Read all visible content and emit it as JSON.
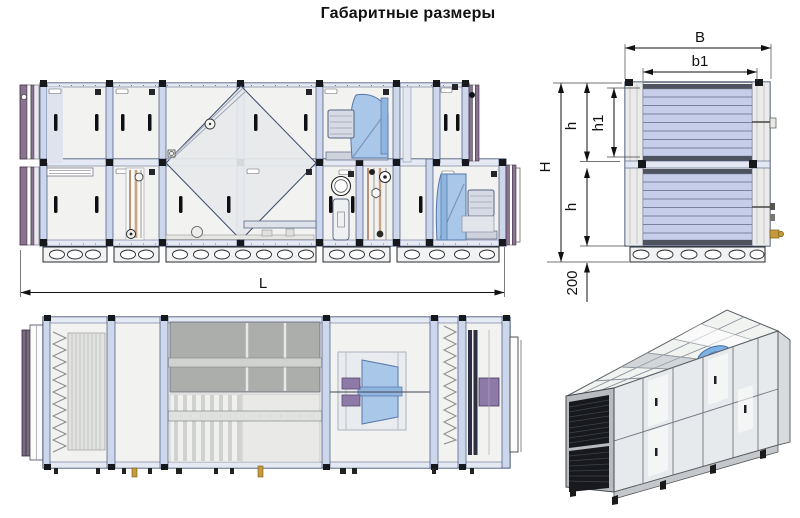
{
  "title": "Габаритные размеры",
  "dimensions": {
    "length": "L",
    "width": "B",
    "inner_width": "b1",
    "height": "H",
    "section_height": "h",
    "inner_height": "h1",
    "base_height": "200"
  },
  "colors": {
    "outline": "#2e3d5c",
    "frame_fill": "#cdd7eb",
    "panel_fill": "#f2f2f0",
    "fan_blue": "#a9c7e8",
    "louver_blue": "#c6cee9",
    "louver_strip": "#4e545f",
    "flange_purple": "#8a7390",
    "motor_purple": "#8d7aa8",
    "exchanger_gray": "#abaeab",
    "pipe_brown": "#b8937a",
    "fitting_gold": "#c49a3e",
    "dim_line": "#1a1a1a"
  }
}
